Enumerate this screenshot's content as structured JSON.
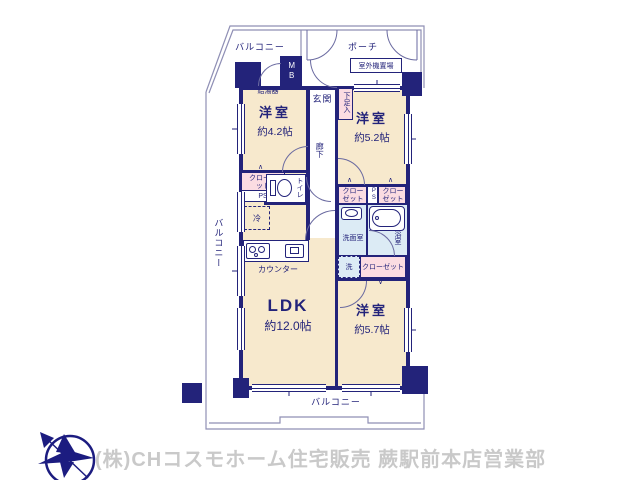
{
  "colors": {
    "wall_navy": "#23237a",
    "room_cream": "#f7e9cd",
    "closet_pink": "#fbdce2",
    "wet_blue": "#dcebf5",
    "outline": "#8f8fb5",
    "footer_gray": "#c9c9c9"
  },
  "plan": {
    "balcony": "バルコニー",
    "porch": "ポーチ",
    "outdoor_unit": "室外機置場",
    "mb": "MB",
    "water_heater": "給湯器",
    "entrance": "玄関",
    "shoe_storage": "下足入",
    "hallway": "廊下",
    "toilet": "トイレ",
    "closet": "クローゼット",
    "ps": "PS",
    "refrigerator": "冷",
    "counter": "カウンター",
    "washroom": "洗面室",
    "bathroom": "浴室",
    "washer": "洗",
    "room_w1": {
      "name": "洋室",
      "size": "約4.2帖"
    },
    "room_w2": {
      "name": "洋室",
      "size": "約5.2帖"
    },
    "room_w3": {
      "name": "洋室",
      "size": "約5.7帖"
    },
    "ldk": {
      "name": "LDK",
      "size": "約12.0帖"
    },
    "icons": {
      "chevron_up": "∧",
      "chevron_down": "∨"
    }
  },
  "footer": {
    "company": "(株)CHコスモホーム住宅販売 蕨駅前本店営業部",
    "logo": "north-compass-bird-logo"
  }
}
